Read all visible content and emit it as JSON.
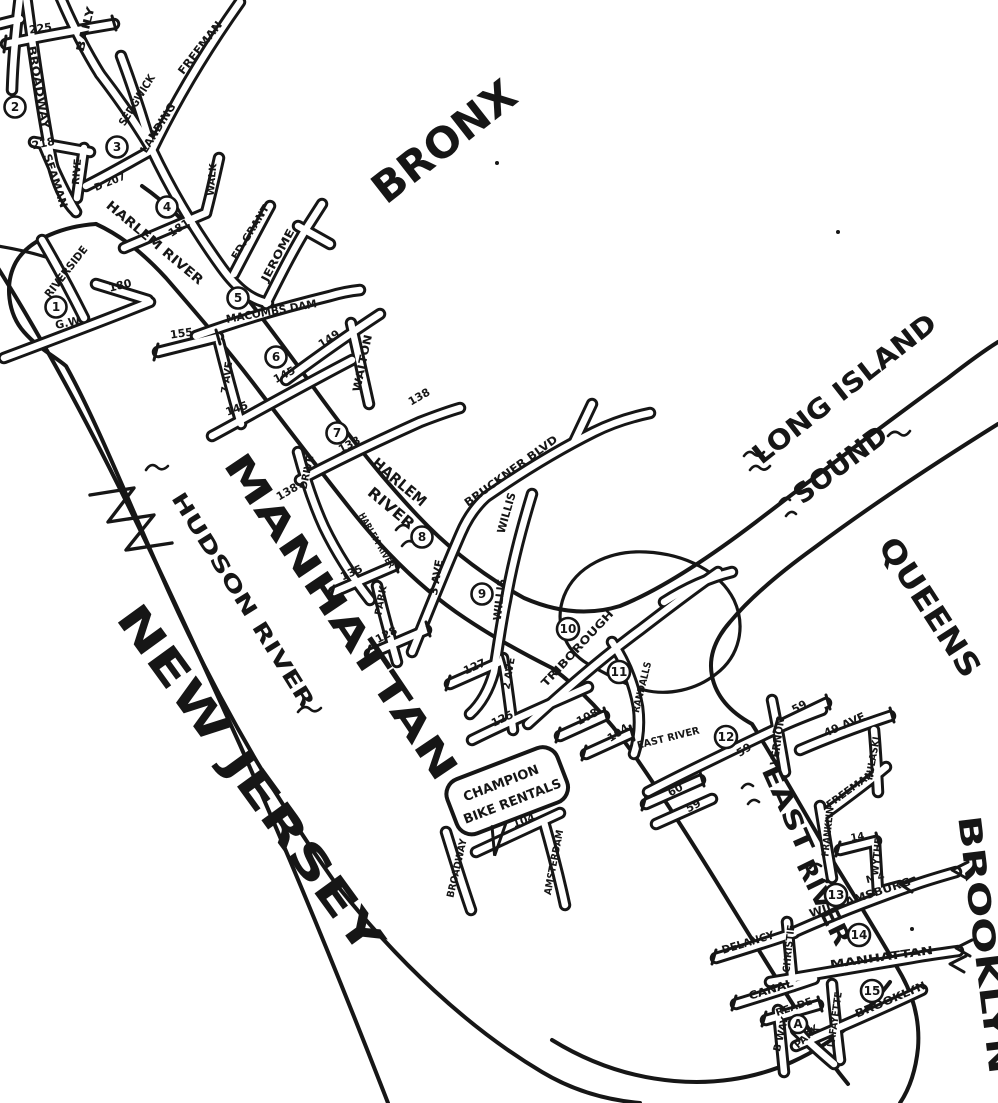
{
  "map": {
    "regions": {
      "bronx": "BRONX",
      "manhattan": "MANHATTAN",
      "new_jersey": "NEW JERSEY",
      "queens": "QUEENS",
      "brooklyn": "BROOKLYN"
    },
    "water": {
      "hudson_river": "HUDSON RIVER",
      "harlem_river_upper": "HARLEM RIVER",
      "harlem_word": "HARLEM",
      "river_word": "RIVER",
      "east_word": "EAST",
      "east_river_word": "RIVER",
      "east_river_small": "EAST RIVER",
      "long_island": "LONG ISLAND",
      "sound": "SOUND"
    },
    "poi": {
      "champion_line1": "CHAMPION",
      "champion_line2": "BIKE RENTALS"
    },
    "streets": {
      "st225": "225",
      "broadway_top": "BROADWAY",
      "baily": "BAILY",
      "sedgwick": "SEDGWICK",
      "freeman_bronx": "FREEMAN",
      "landing": "LANDING",
      "st218": "218",
      "seaman": "SEAMAN",
      "rive": "RIVE",
      "d207": "D 207",
      "riverside": "RIVERSIDE",
      "st180": "180",
      "gw": "G.W.",
      "st155": "155",
      "st181": "181",
      "walk": "WALK",
      "ed_grant": "ED.GRANT",
      "jerome": "JEROME",
      "macombs_dam": "MACOMBS DAM",
      "ave7": "7 AVE",
      "st149": "149",
      "st145_bronx": "145",
      "st145_bridge": "145",
      "walton": "WALTON",
      "st138_bronx": "138",
      "st138_bridge": "138",
      "st138_manh": "138",
      "drive": "DRIVE",
      "harlem_river_drive": "HARLEM RIVER",
      "st135": "135",
      "park_ave": "PARK",
      "st128": "128",
      "ave3": "3 AVE",
      "bruckner": "BRUCKNER BLVD",
      "willis_upper": "WILLIS",
      "willis_lower": "WILLIS",
      "st127": "127",
      "ave2": "2 AVE",
      "st125": "125",
      "triborough": "TRIBOROUGH",
      "randalls": "RANDALLS",
      "st108": "108",
      "st104_east": "104",
      "st60": "60",
      "st59_manh": "59",
      "st59_bridge": "59",
      "st59_queens": "59",
      "vernon": "VERNON",
      "ave49": "49 AVE",
      "pulaski": "PULASKI",
      "freeman_bk": "FREEMAN",
      "franklin": "FRANKLIN",
      "st14": "14",
      "wythe": "WYTHE",
      "n4": "N 4",
      "williamsburg": "WILLIAMSBURG",
      "delancy": "DELANCY",
      "christie": "CHRISTIE",
      "manhattan_bridge": "MANHATTAN",
      "canal": "CANAL",
      "reade": "READE",
      "bway": "B'WAY",
      "park_row": "PARK",
      "lafayette": "LAFAYETTE",
      "brooklyn_bridge": "BROOKLYN",
      "st104_west": "104",
      "broadway_uws": "BROADWAY",
      "amsterdam": "AMSTERDAM"
    },
    "markers": [
      {
        "label": "1"
      },
      {
        "label": "2"
      },
      {
        "label": "3"
      },
      {
        "label": "4"
      },
      {
        "label": "5"
      },
      {
        "label": "6"
      },
      {
        "label": "7"
      },
      {
        "label": "8"
      },
      {
        "label": "9"
      },
      {
        "label": "10"
      },
      {
        "label": "11"
      },
      {
        "label": "12"
      },
      {
        "label": "13"
      },
      {
        "label": "14"
      },
      {
        "label": "15"
      },
      {
        "label": "A"
      }
    ]
  }
}
